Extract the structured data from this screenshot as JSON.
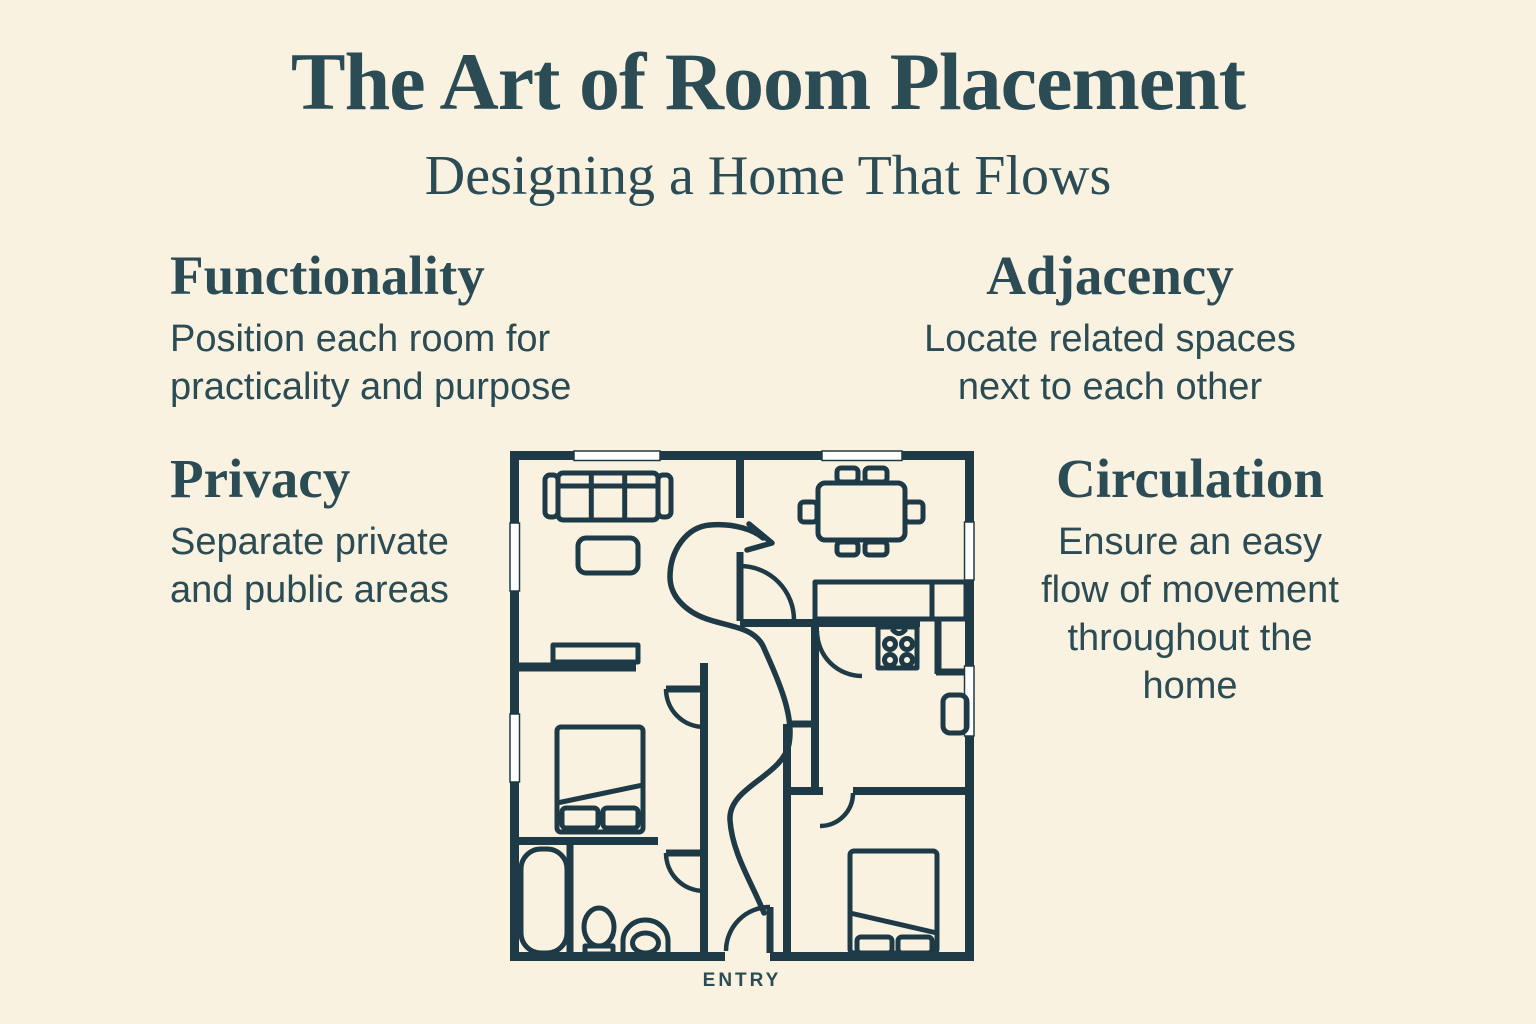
{
  "colors": {
    "background": "#faf2e0",
    "ink": "#2b4b55",
    "wall": "#1e3a47",
    "window_fill": "#ffffff"
  },
  "header": {
    "title": "The Art of Room Placement",
    "subtitle": "Designing a Home That Flows"
  },
  "sections": {
    "functionality": {
      "heading": "Functionality",
      "body": "Position each room for\npracticality and purpose"
    },
    "adjacency": {
      "heading": "Adjacency",
      "body": "Locate related spaces\nnext to each other"
    },
    "privacy": {
      "heading": "Privacy",
      "body": "Separate private\nand public areas"
    },
    "circulation": {
      "heading": "Circulation",
      "body": "Ensure an easy\nflow of movement\nthroughout the\nhome"
    }
  },
  "floorplan": {
    "entry_label": "ENTRY",
    "icons": [
      "sofa-icon",
      "coffee-table-icon",
      "sideboard-icon",
      "dining-table-icon",
      "dining-chair-icon",
      "kitchen-counter-icon",
      "stove-icon",
      "fridge-icon",
      "bed-icon",
      "bathtub-icon",
      "sink-icon",
      "toilet-icon",
      "door-arc-icon",
      "window-icon",
      "flow-arrow-icon"
    ]
  }
}
